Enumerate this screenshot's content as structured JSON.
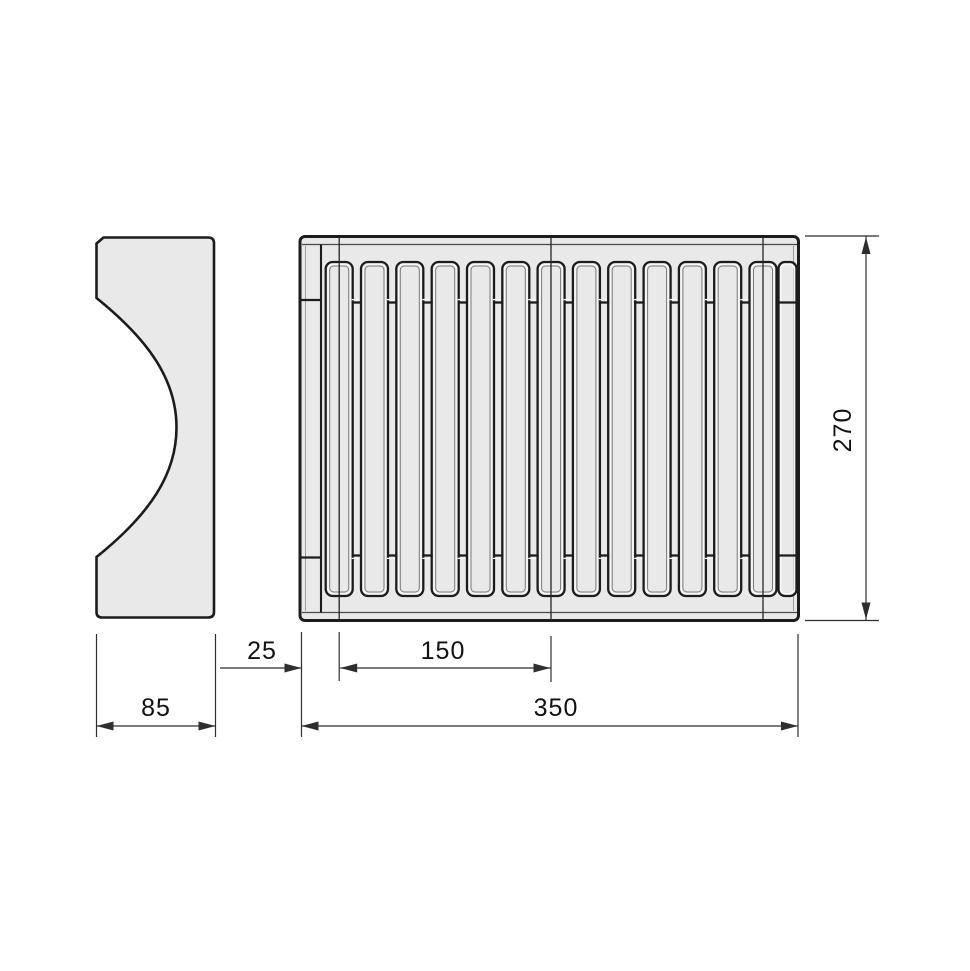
{
  "colors": {
    "background": "#ffffff",
    "part_fill": "#e9e9e9",
    "outline": "#1c1c1c",
    "inner_line": "#4a4a4a",
    "highlight": "#f7f7f7",
    "dim_line": "#2e2e2e",
    "dim_text": "#111111"
  },
  "front_view": {
    "slat_count": 13,
    "width_dim": "350",
    "height_dim": "270",
    "edge_offset_dim": "25",
    "slat_span_dim": "150"
  },
  "side_view": {
    "width_dim": "85"
  },
  "dimensions": {
    "d25": "25",
    "d150": "150",
    "d350": "350",
    "d85": "85",
    "d270": "270"
  }
}
